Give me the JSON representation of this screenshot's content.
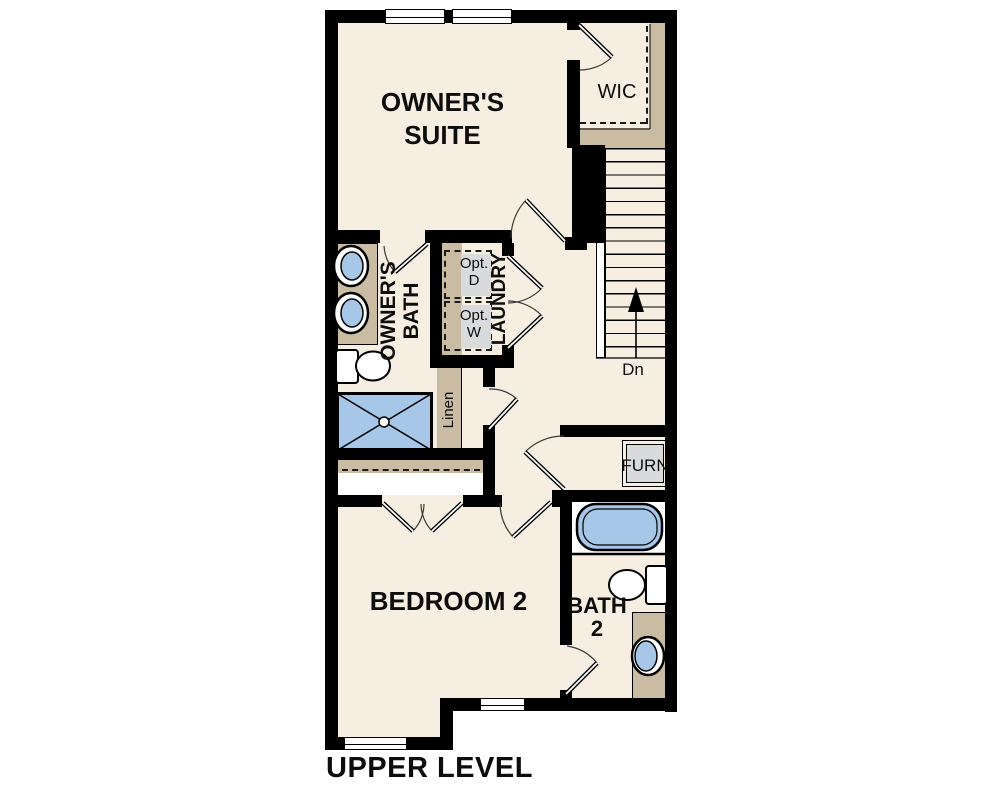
{
  "level_label": "UPPER LEVEL",
  "labels": {
    "owners_suite_line1": "OWNER'S",
    "owners_suite_line2": "SUITE",
    "wic": "WIC",
    "owners_bath_line1": "OWNER'S",
    "owners_bath_line2": "BATH",
    "laundry": "LAUNDRY",
    "opt_dryer_line1": "Opt.",
    "opt_dryer_line2": "D",
    "opt_washer_line1": "Opt.",
    "opt_washer_line2": "W",
    "linen": "Linen",
    "stairs_down": "Dn",
    "furnace": "FURN",
    "bedroom2": "BEDROOM 2",
    "bath2_line1": "BATH",
    "bath2_line2": "2"
  },
  "colors": {
    "floor": "#f6eee0",
    "wall": "#000000",
    "cabinet_tan": "#c9bca3",
    "fixture_blue": "#a7c7e8",
    "appliance_gray": "#d9dadb"
  }
}
